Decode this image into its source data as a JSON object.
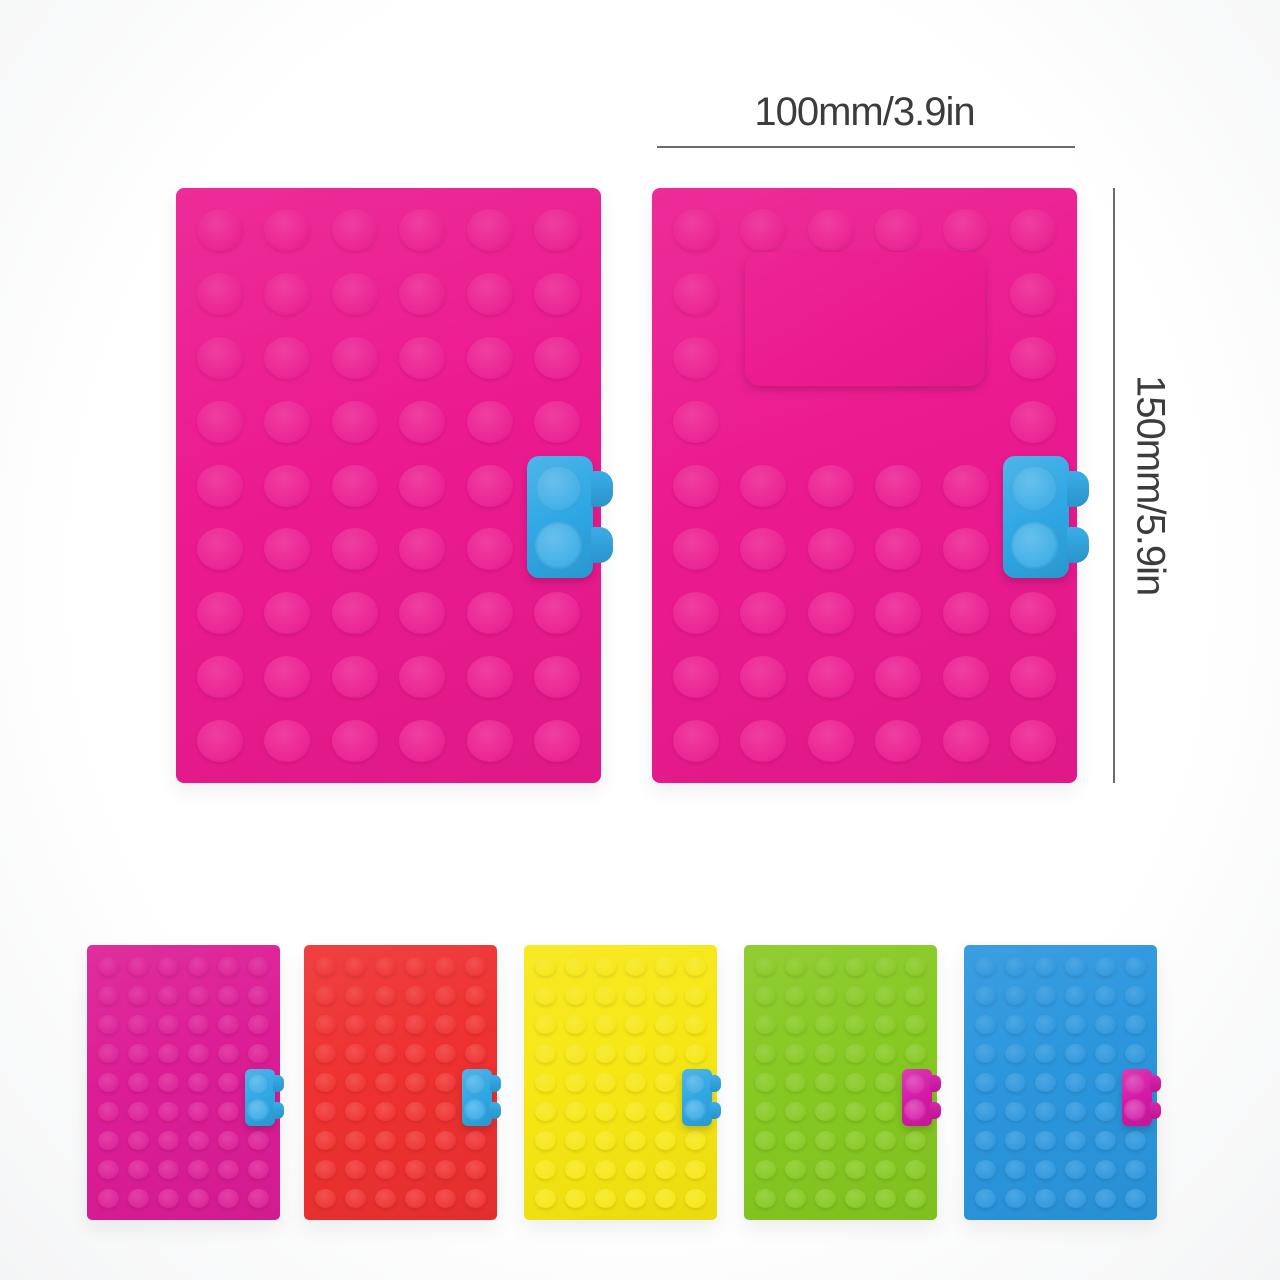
{
  "photo": {
    "description": "building-block silicone notebook covers product photo",
    "dimensions": {
      "width_label": "100mm/3.9in",
      "height_label": "150mm/5.9in",
      "text_color": "#3c3c3c",
      "line_color": "#6b6b6b"
    },
    "plates": {
      "grid": {
        "cols": 6,
        "rows": 9
      },
      "large": [
        {
          "name": "back-cover",
          "color": "#eb1a8f",
          "clasp_color": "#2fa8e5",
          "window": false
        },
        {
          "name": "front-cover",
          "color": "#eb1a8f",
          "clasp_color": "#2fa8e5",
          "window": true
        }
      ],
      "small": [
        {
          "name": "pink-variant",
          "color": "#dc1d95",
          "clasp_color": "#2fa8e5",
          "window": false
        },
        {
          "name": "red-variant",
          "color": "#ee3130",
          "clasp_color": "#2fa8e5",
          "window": false
        },
        {
          "name": "yellow-variant",
          "color": "#f6e713",
          "clasp_color": "#2fa8e5",
          "window": false
        },
        {
          "name": "green-variant",
          "color": "#86c922",
          "clasp_color": "#d619a8",
          "window": false
        },
        {
          "name": "blue-variant",
          "color": "#2b96dd",
          "clasp_color": "#d619a8",
          "window": false
        }
      ]
    }
  }
}
